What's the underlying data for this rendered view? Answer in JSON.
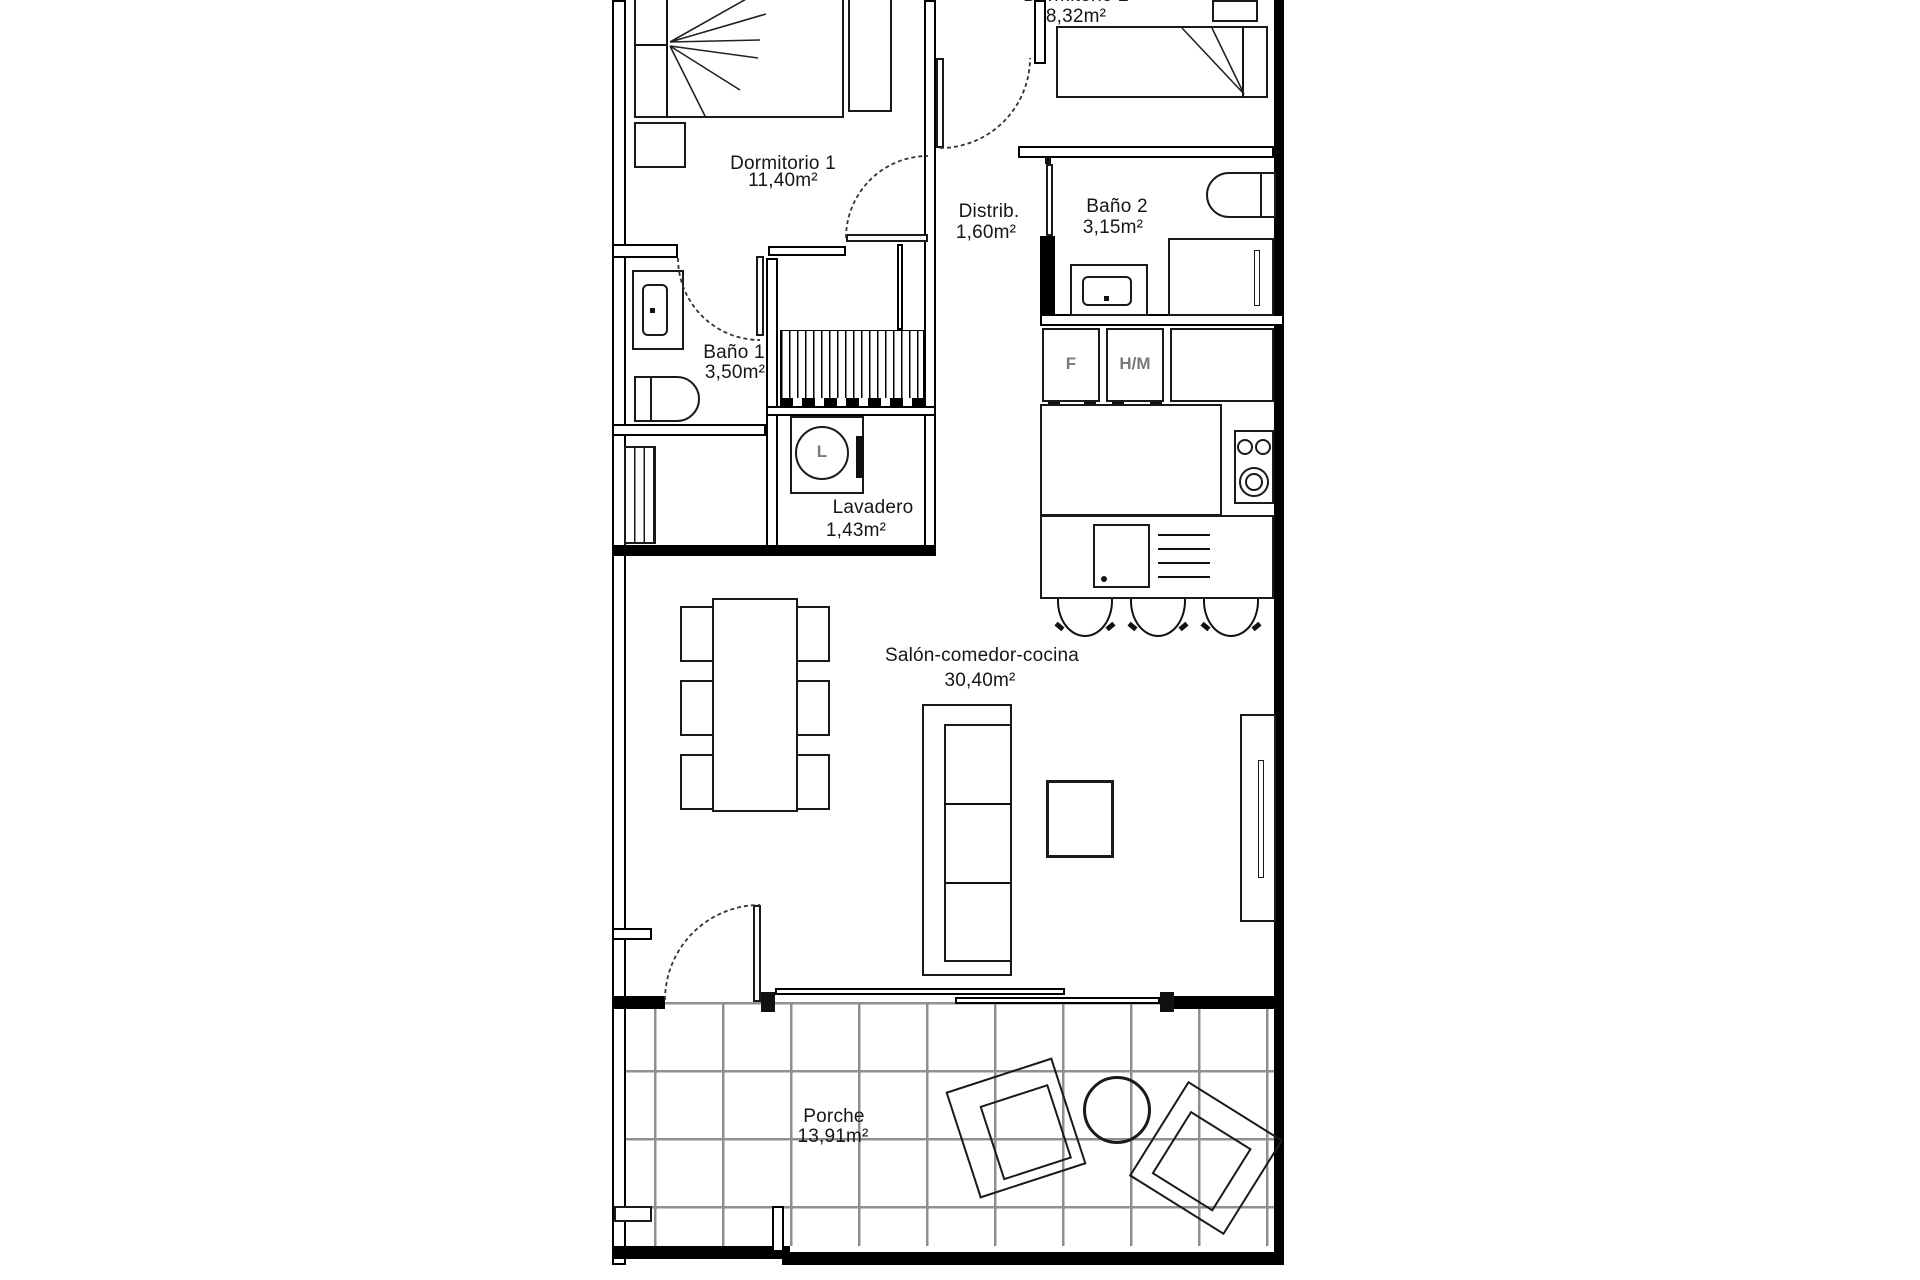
{
  "rooms": {
    "dormitorio1": {
      "name": "Dormitorio 1",
      "area": "11,40m²"
    },
    "dormitorio2": {
      "name": "Dormitorio 2",
      "area": "8,32m²"
    },
    "distribuidor": {
      "name": "Distrib.",
      "area": "1,60m²"
    },
    "bano1": {
      "name": "Baño 1",
      "area": "3,50m²"
    },
    "bano2": {
      "name": "Baño 2",
      "area": "3,15m²"
    },
    "lavadero": {
      "name": "Lavadero",
      "area": "1,43m²"
    },
    "salon": {
      "name": "Salón-comedor-cocina",
      "area": "30,40m²"
    },
    "porche": {
      "name": "Porche",
      "area": "13,91m²"
    }
  },
  "appliance_labels": {
    "fridge": "F",
    "oven_microwave": "H/M",
    "washing_machine": "L"
  },
  "colors": {
    "wall": "#000000",
    "line": "#1a1a1a",
    "grid_line": "#8f8f8f",
    "appliance_text": "#7a7a7a",
    "background": "#ffffff"
  }
}
